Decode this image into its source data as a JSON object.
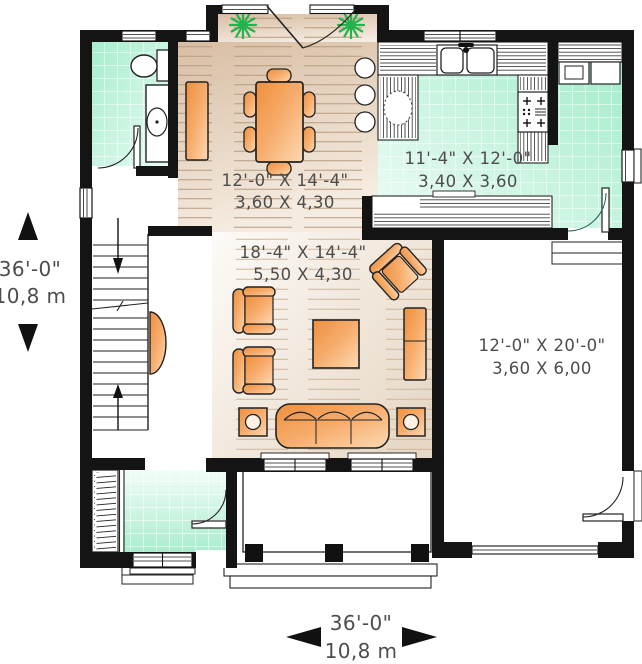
{
  "plan": {
    "rooms": [
      {
        "name": "dining",
        "imperial": "12'-0\" X 14'-4\"",
        "metric": "3,60 X 4,30"
      },
      {
        "name": "kitchen",
        "imperial": "11'-4\" X 12'-0\"",
        "metric": "3,40 X 3,60"
      },
      {
        "name": "living",
        "imperial": "18'-4\" X 14'-4\"",
        "metric": "5,50 X 4,30"
      },
      {
        "name": "garage",
        "imperial": "12'-0\" X 20'-0\"",
        "metric": "3,60 X 6,00"
      }
    ],
    "overall_dimensions": {
      "left": {
        "imperial": "36'-0\"",
        "metric": "10,8 m"
      },
      "bottom": {
        "imperial": "36'-0\"",
        "metric": "10,8 m"
      }
    },
    "icons": {
      "plant": "green-starburst",
      "stair_up": "arrow-up",
      "stair_down": "arrow-down",
      "dimension_marker": "black-triangle"
    },
    "colors": {
      "wall": "#141414",
      "tile": "#a3eccc",
      "wood": "#d8bda3",
      "furniture": "#f5a55c",
      "plant": "#23b24b",
      "text": "#4d4d4d",
      "background": "#ffffff"
    }
  }
}
